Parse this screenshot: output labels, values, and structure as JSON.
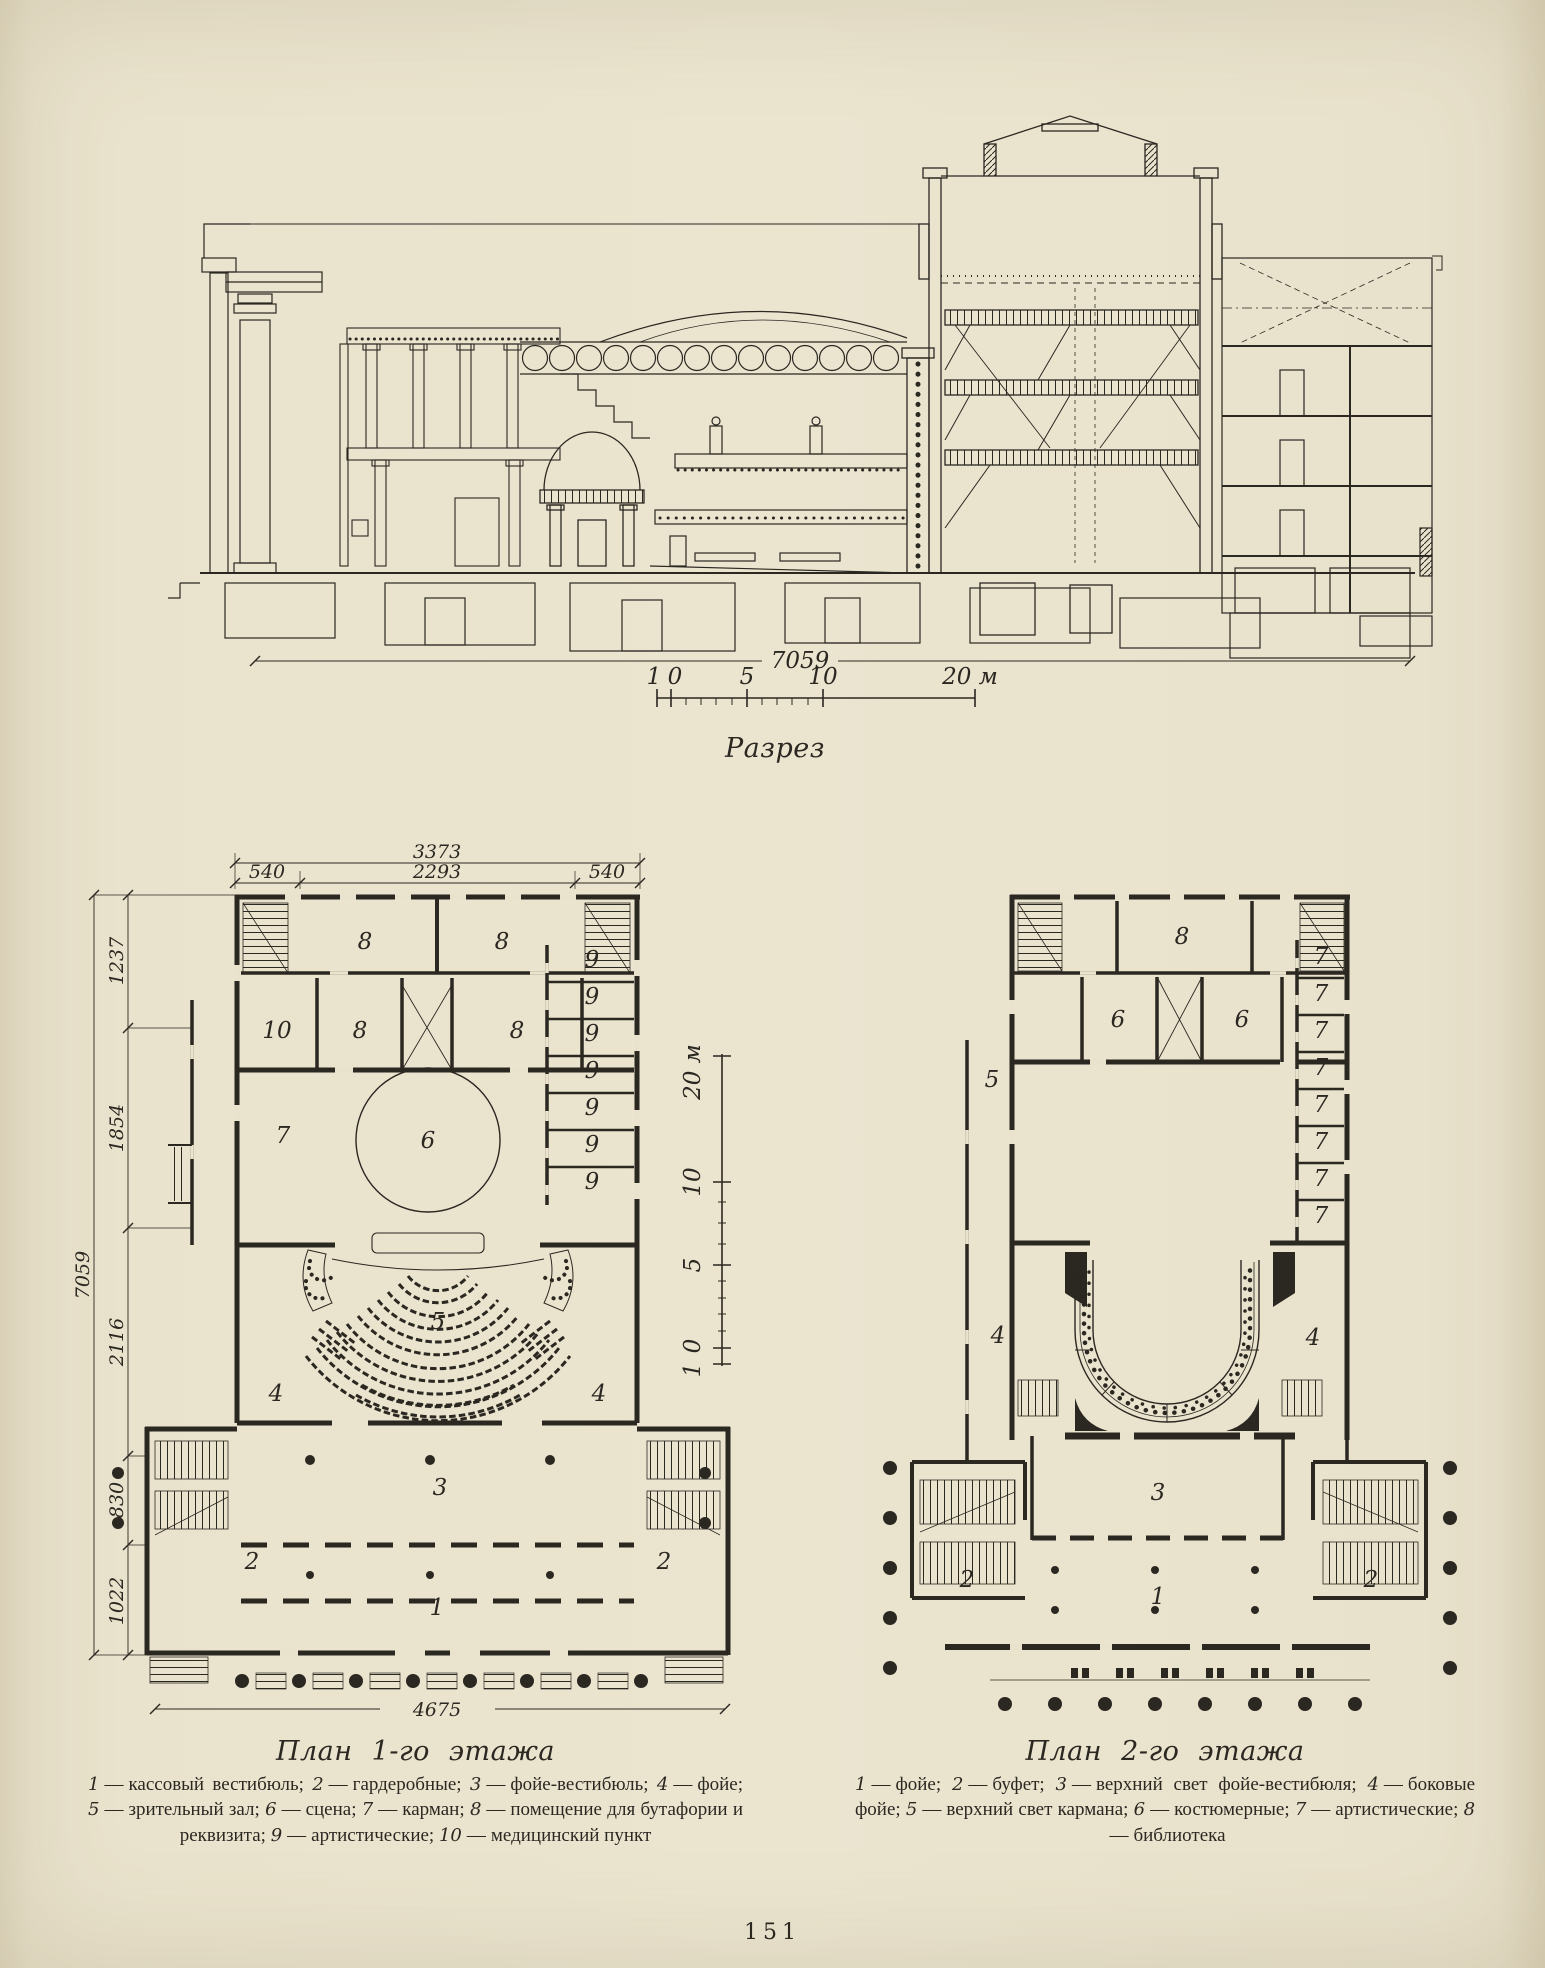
{
  "page": {
    "number": "151"
  },
  "ui": {
    "dash": "—"
  },
  "section": {
    "caption": "Разрез",
    "dim_total": "7059",
    "scale": {
      "l1": "1",
      "l0": "0",
      "l5": "5",
      "l10": "10",
      "l20": "20 м"
    }
  },
  "vscale": {
    "l20": "20 м",
    "l10": "10",
    "l5": "5",
    "l0": "0",
    "l1": "1"
  },
  "plan1": {
    "caption": "План 1-го этажа",
    "dims": {
      "top_total": "3373",
      "seg_left": "540",
      "seg_mid": "2293",
      "seg_right": "540",
      "left_total": "7059",
      "v1": "1237",
      "v2": "1854",
      "v3": "2116",
      "v4": "830",
      "v5": "1022",
      "bottom": "4675"
    },
    "rooms": {
      "r8a": "8",
      "r8b": "8",
      "r10": "10",
      "r8c": "8",
      "r8d": "8",
      "n9": [
        "9",
        "9",
        "9",
        "9",
        "9",
        "9",
        "9"
      ],
      "r7": "7",
      "r6": "6",
      "r5": "5",
      "r4a": "4",
      "r4b": "4",
      "r3": "3",
      "r2a": "2",
      "r2b": "2",
      "r1": "1"
    },
    "legend": [
      {
        "n": "1",
        "t": "кассовый вестибюль;"
      },
      {
        "n": "2",
        "t": "гардеробные;"
      },
      {
        "n": "3",
        "t": "фойе-вестибюль;"
      },
      {
        "n": "4",
        "t": "фойе;"
      },
      {
        "n": "5",
        "t": "зрительный зал;"
      },
      {
        "n": "6",
        "t": "сцена;"
      },
      {
        "n": "7",
        "t": "карман;"
      },
      {
        "n": "8",
        "t": "помещение для бутафории и реквизита;"
      },
      {
        "n": "9",
        "t": "артистические;"
      },
      {
        "n": "10",
        "t": "медицинский пункт"
      }
    ]
  },
  "plan2": {
    "caption": "План 2-го этажа",
    "rooms": {
      "r8": "8",
      "r6a": "6",
      "r6b": "6",
      "n7": [
        "7",
        "7",
        "7",
        "7",
        "7",
        "7",
        "7",
        "7"
      ],
      "r5": "5",
      "r4a": "4",
      "r4b": "4",
      "r3": "3",
      "r2a": "2",
      "r2b": "2",
      "r1": "1"
    },
    "legend": [
      {
        "n": "1",
        "t": "фойе;"
      },
      {
        "n": "2",
        "t": "буфет;"
      },
      {
        "n": "3",
        "t": "верхний свет фойе-вестибюля;"
      },
      {
        "n": "4",
        "t": "боковые фойе;"
      },
      {
        "n": "5",
        "t": "верхний свет кармана;"
      },
      {
        "n": "6",
        "t": "костюмерные;"
      },
      {
        "n": "7",
        "t": "артистические;"
      },
      {
        "n": "8",
        "t": "библиотека"
      }
    ]
  }
}
